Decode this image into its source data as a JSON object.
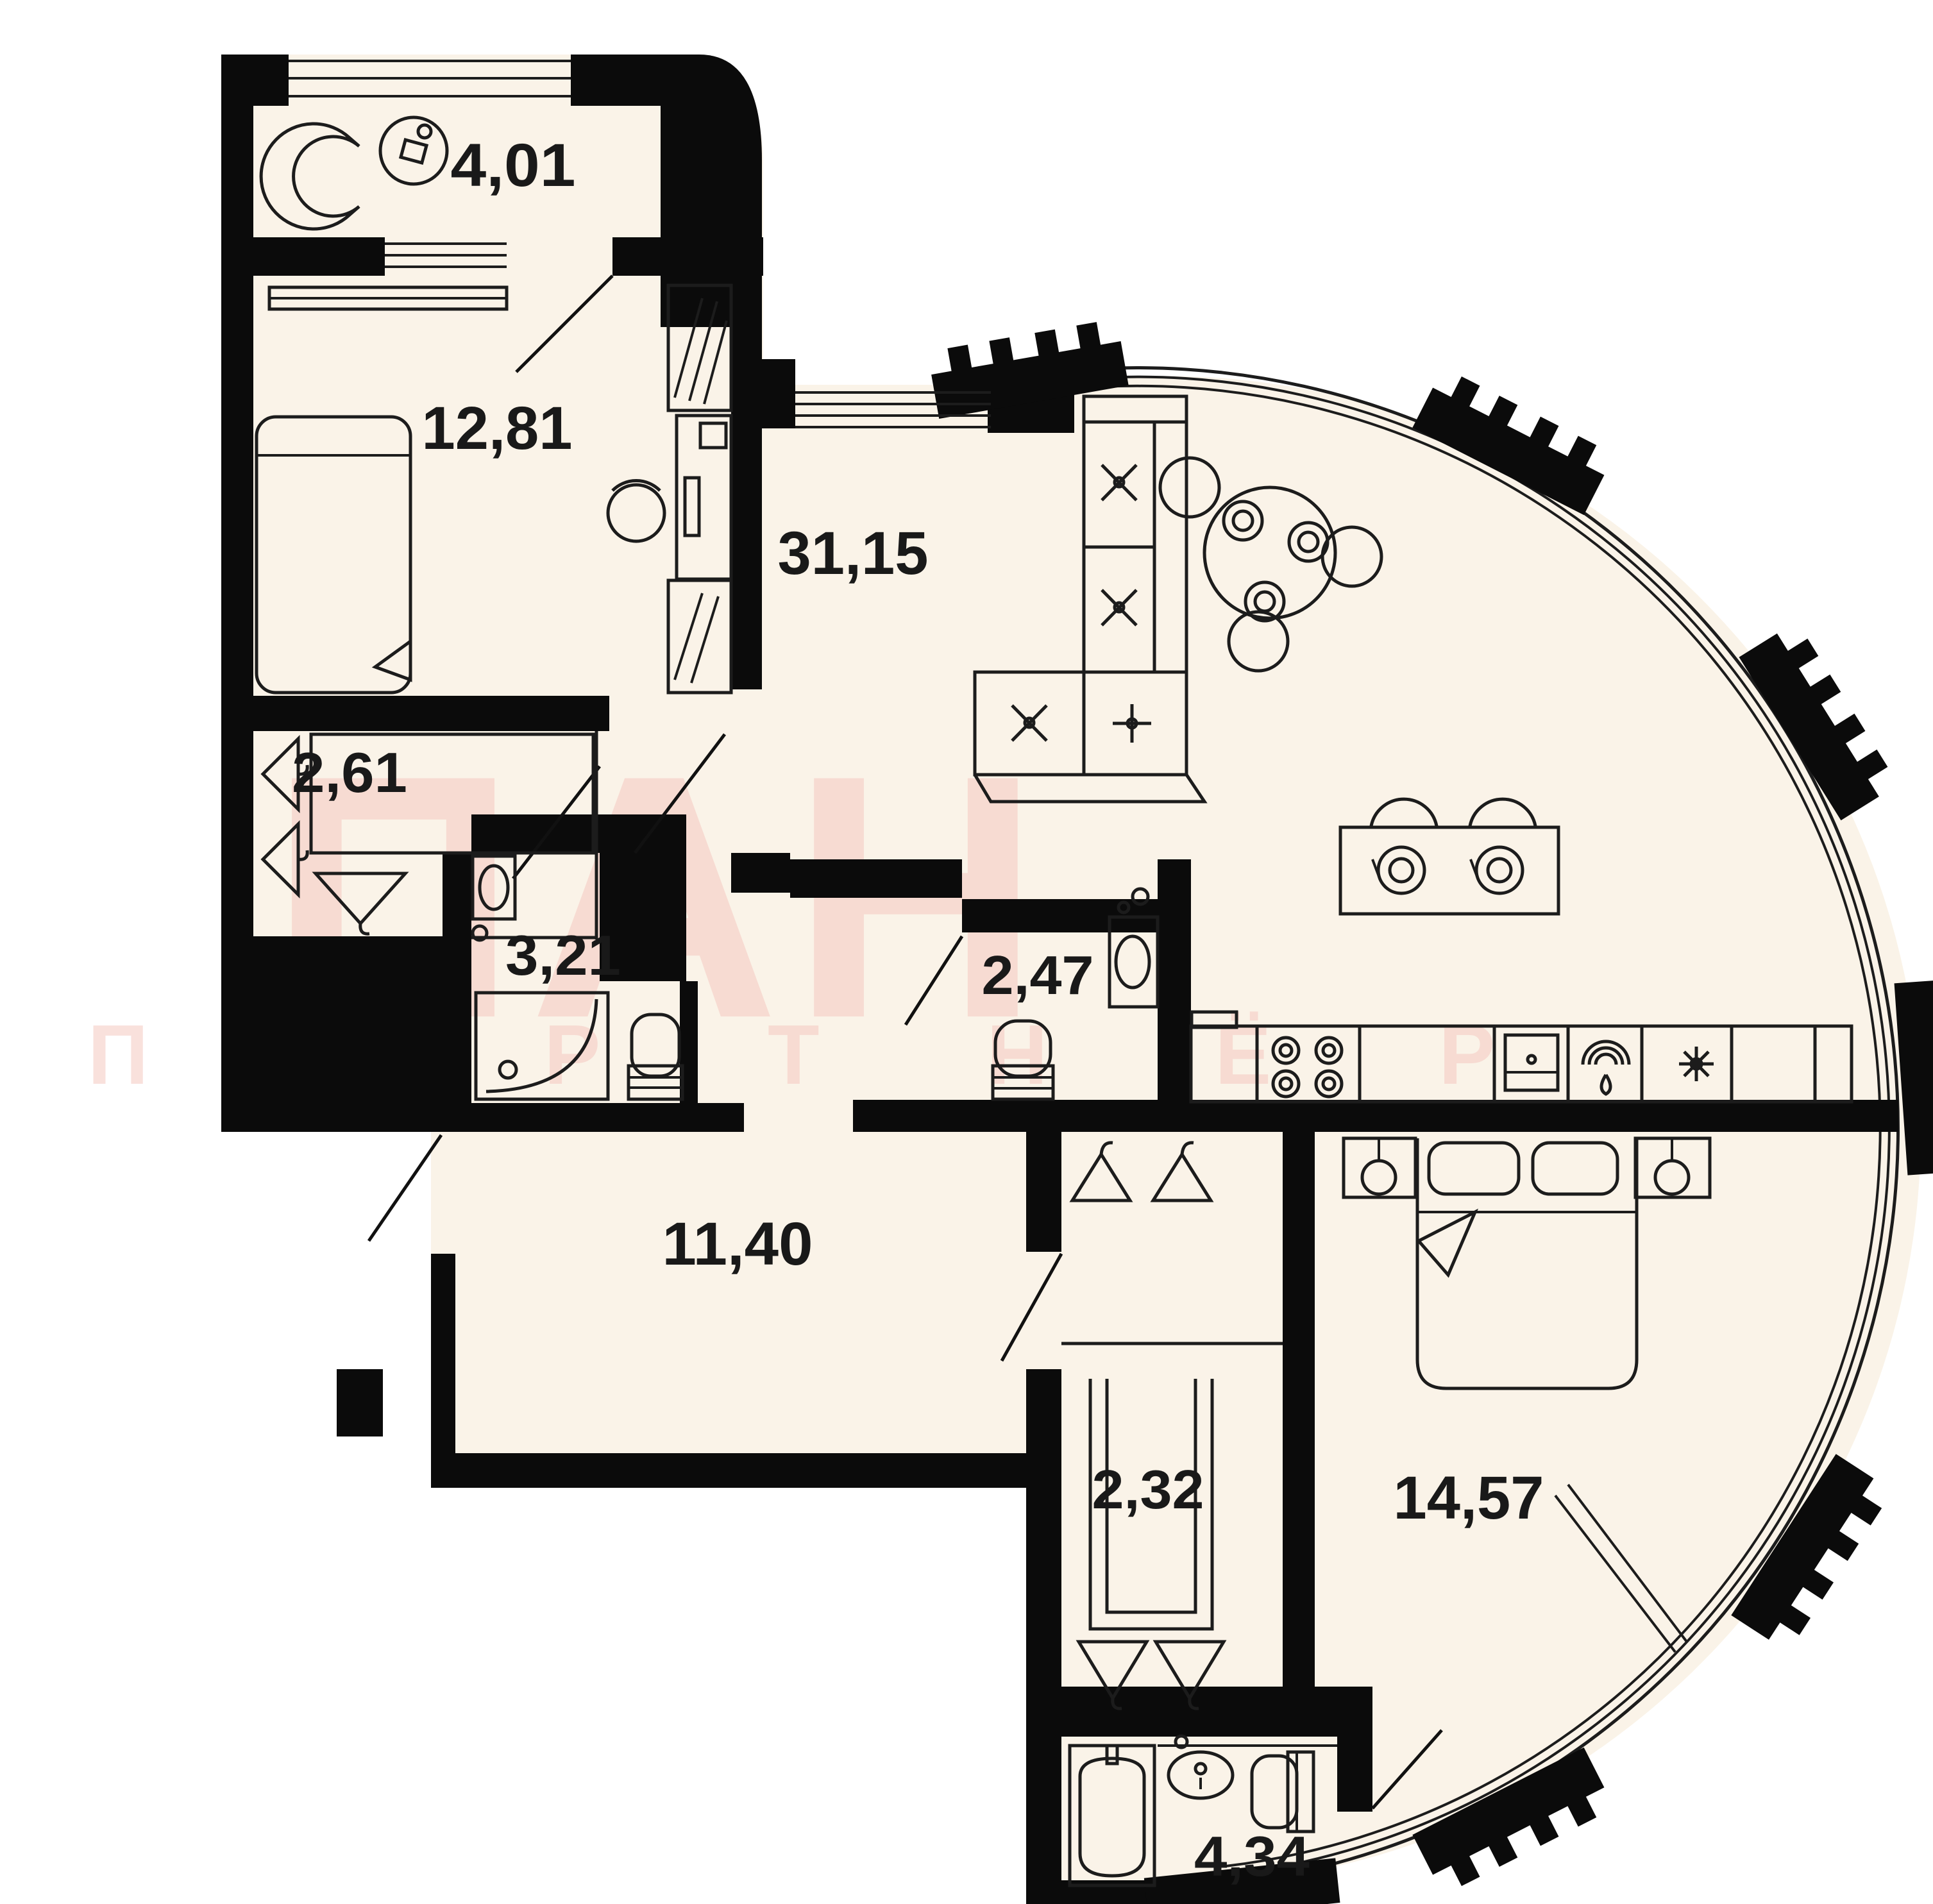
{
  "plan": {
    "type": "apartment-floor-plan",
    "rooms": [
      {
        "name": "loggia",
        "area": "4,01"
      },
      {
        "name": "bedroom",
        "area": "12,81"
      },
      {
        "name": "wardrobe",
        "area": "2,61"
      },
      {
        "name": "shower-room",
        "area": "3,21"
      },
      {
        "name": "living-room-kitchen",
        "area": "31,15"
      },
      {
        "name": "wc",
        "area": "2,47"
      },
      {
        "name": "hallway",
        "area": "11,40"
      },
      {
        "name": "closet",
        "area": "2,32"
      },
      {
        "name": "bedroom-2",
        "area": "14,57"
      },
      {
        "name": "bathroom",
        "area": "4,34"
      }
    ],
    "watermark": {
      "title": "ПАН",
      "subtitle": "П А Р Т Н Ё Р"
    },
    "colors": {
      "wall": "#0b0b0b",
      "floor": "#faf3e8",
      "line": "#1c1c1c",
      "watermark": "#f5c9c1",
      "background": "#ffffff"
    }
  }
}
